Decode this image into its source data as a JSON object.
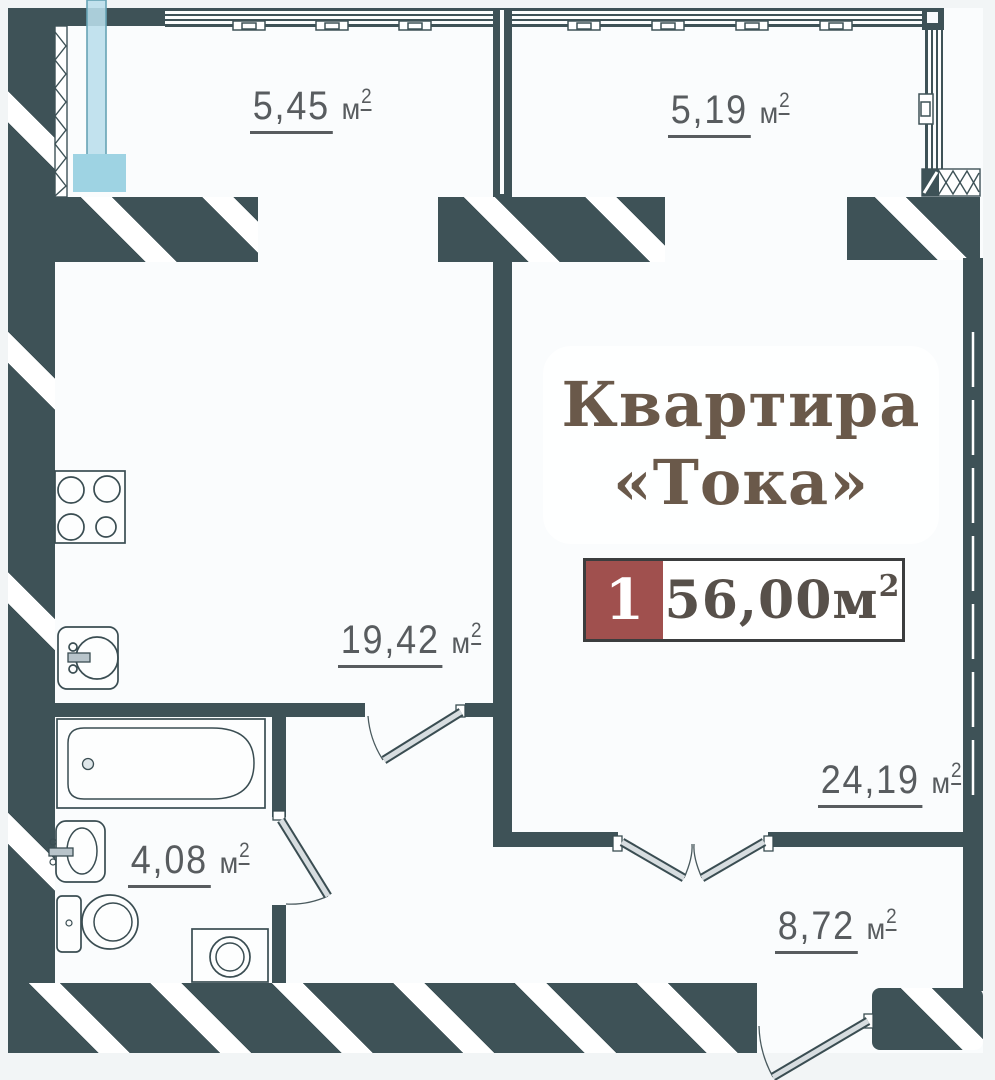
{
  "title": {
    "line1": "Квартира",
    "line2": "«Тока»"
  },
  "badge": {
    "number": "1",
    "area": "56,00",
    "unit": "м",
    "sup": "2"
  },
  "rooms": {
    "balcony_left": {
      "value": "5,45",
      "unit": "м",
      "sup": "2"
    },
    "balcony_right": {
      "value": "5,19",
      "unit": "м",
      "sup": "2"
    },
    "kitchen_living": {
      "value": "19,42",
      "unit": "м",
      "sup": "2"
    },
    "bedroom": {
      "value": "24,19",
      "unit": "м",
      "sup": "2"
    },
    "bathroom": {
      "value": "4,08",
      "unit": "м",
      "sup": "2"
    },
    "hallway": {
      "value": "8,72",
      "unit": "м",
      "sup": "2"
    }
  },
  "colors": {
    "wall": "#3e5257",
    "accent_red": "#a0504e",
    "title_brown": "#6a594a",
    "area_text": "#585c5f",
    "pipe_blue": "#9ed3e3",
    "page_bg": "#f2f5f6"
  }
}
